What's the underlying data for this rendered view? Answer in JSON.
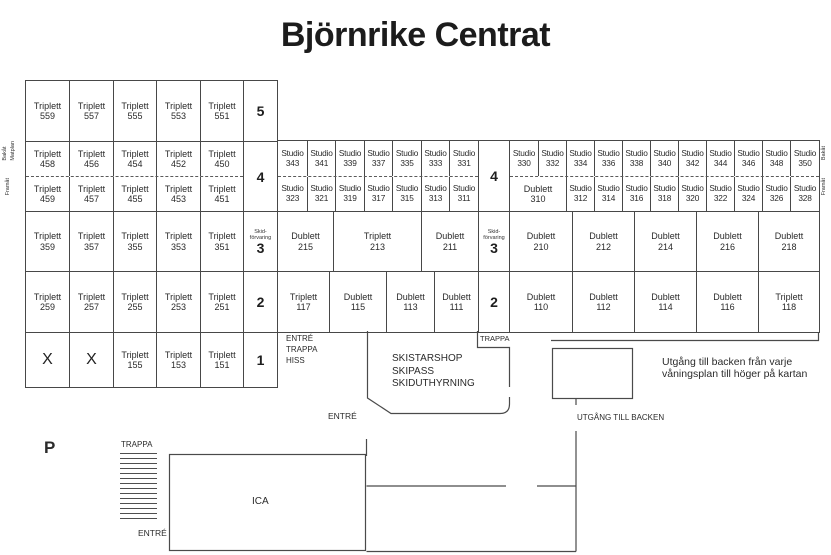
{
  "title": "Björnrike Centrat",
  "orientation_labels": {
    "left_top_a": "Bakåt",
    "left_top_b": "Matplan",
    "left_bottom": "Framåt",
    "right_top": "Bakåt",
    "right_bottom": "Framåt"
  },
  "floor_labels": {
    "f5": "5",
    "f4": "4",
    "f3": "3",
    "f2": "2",
    "f1": "1",
    "skid_line1": "Skid-",
    "skid_line2": "förvaring"
  },
  "left_block": {
    "floor5": [
      [
        "Triplett",
        "559"
      ],
      [
        "Triplett",
        "557"
      ],
      [
        "Triplett",
        "555"
      ],
      [
        "Triplett",
        "553"
      ],
      [
        "Triplett",
        "551"
      ]
    ],
    "floor4_back": [
      [
        "Triplett",
        "458"
      ],
      [
        "Triplett",
        "456"
      ],
      [
        "Triplett",
        "454"
      ],
      [
        "Triplett",
        "452"
      ],
      [
        "Triplett",
        "450"
      ]
    ],
    "floor4_front": [
      [
        "Triplett",
        "459"
      ],
      [
        "Triplett",
        "457"
      ],
      [
        "Triplett",
        "455"
      ],
      [
        "Triplett",
        "453"
      ],
      [
        "Triplett",
        "451"
      ]
    ],
    "floor3": [
      [
        "Triplett",
        "359"
      ],
      [
        "Triplett",
        "357"
      ],
      [
        "Triplett",
        "355"
      ],
      [
        "Triplett",
        "353"
      ],
      [
        "Triplett",
        "351"
      ]
    ],
    "floor2": [
      [
        "Triplett",
        "259"
      ],
      [
        "Triplett",
        "257"
      ],
      [
        "Triplett",
        "255"
      ],
      [
        "Triplett",
        "253"
      ],
      [
        "Triplett",
        "251"
      ]
    ],
    "floor1": [
      [
        "X"
      ],
      [
        "X"
      ],
      [
        "Triplett",
        "155"
      ],
      [
        "Triplett",
        "153"
      ],
      [
        "Triplett",
        "151"
      ]
    ]
  },
  "middle_block": {
    "floor4_back": [
      [
        "Studio",
        "343"
      ],
      [
        "Studio",
        "341"
      ],
      [
        "Studio",
        "339"
      ],
      [
        "Studio",
        "337"
      ],
      [
        "Studio",
        "335"
      ],
      [
        "Studio",
        "333"
      ],
      [
        "Studio",
        "331"
      ]
    ],
    "floor4_front": [
      [
        "Studio",
        "323"
      ],
      [
        "Studio",
        "321"
      ],
      [
        "Studio",
        "319"
      ],
      [
        "Studio",
        "317"
      ],
      [
        "Studio",
        "315"
      ],
      [
        "Studio",
        "313"
      ],
      [
        "Studio",
        "311"
      ]
    ],
    "floor3": [
      [
        "Dublett",
        "215"
      ],
      [
        "Triplett",
        "213"
      ],
      [
        "Dublett",
        "211"
      ]
    ],
    "floor2": [
      [
        "Triplett",
        "117"
      ],
      [
        "Dublett",
        "115"
      ],
      [
        "Dublett",
        "113"
      ],
      [
        "Dublett",
        "111"
      ]
    ]
  },
  "right_block": {
    "floor4_back": [
      [
        "Studio",
        "330"
      ],
      [
        "Studio",
        "332"
      ],
      [
        "Studio",
        "334"
      ],
      [
        "Studio",
        "336"
      ],
      [
        "Studio",
        "338"
      ],
      [
        "Studio",
        "340"
      ],
      [
        "Studio",
        "342"
      ],
      [
        "Studio",
        "344"
      ],
      [
        "Studio",
        "346"
      ],
      [
        "Studio",
        "348"
      ],
      [
        "Studio",
        "350"
      ]
    ],
    "floor4_front": [
      [
        "Dublett",
        "310"
      ],
      [
        "Studio",
        "312"
      ],
      [
        "Studio",
        "314"
      ],
      [
        "Studio",
        "316"
      ],
      [
        "Studio",
        "318"
      ],
      [
        "Studio",
        "320"
      ],
      [
        "Studio",
        "322"
      ],
      [
        "Studio",
        "324"
      ],
      [
        "Studio",
        "326"
      ],
      [
        "Studio",
        "328"
      ]
    ],
    "floor3": [
      [
        "Dublett",
        "210"
      ],
      [
        "Dublett",
        "212"
      ],
      [
        "Dublett",
        "214"
      ],
      [
        "Dublett",
        "216"
      ],
      [
        "Dublett",
        "218"
      ]
    ],
    "floor2": [
      [
        "Dublett",
        "110"
      ],
      [
        "Dublett",
        "112"
      ],
      [
        "Dublett",
        "114"
      ],
      [
        "Dublett",
        "116"
      ],
      [
        "Triplett",
        "118"
      ]
    ]
  },
  "labels": {
    "entre_trappa_hiss": [
      "ENTRÉ",
      "TRAPPA",
      "HISS"
    ],
    "trappa_mid": "TRAPPA",
    "shop": [
      "SKISTARSHOP",
      "SKIPASS",
      "SKIDUTHYRNING"
    ],
    "entre_shop": "ENTRÉ",
    "utgang_till_backen": "UTGÅNG TILL BACKEN",
    "note": [
      "Utgång till backen från varje",
      "våningsplan till höger på kartan"
    ],
    "parking": "P",
    "trappa_left": "TRAPPA",
    "entre_left": "ENTRÉ",
    "ica": "ICA"
  },
  "colors": {
    "line": "#484848",
    "text": "#262626",
    "background": "#ffffff"
  }
}
